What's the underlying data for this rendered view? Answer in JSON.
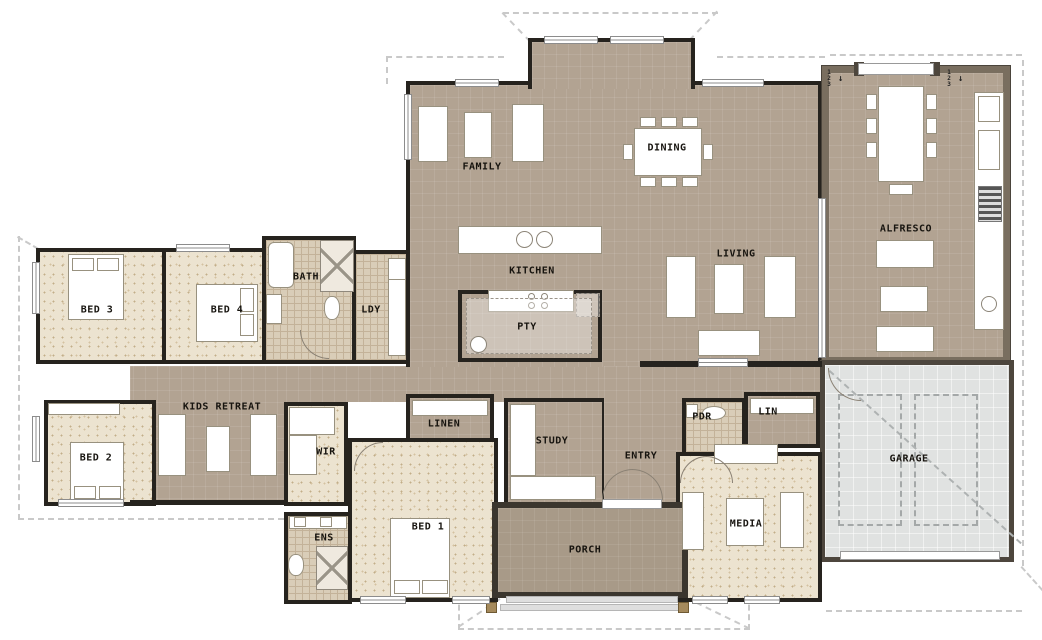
{
  "plan": {
    "rooms": {
      "family": {
        "label": "FAMILY"
      },
      "dining": {
        "label": "DINING"
      },
      "kitchen": {
        "label": "KITCHEN"
      },
      "pantry": {
        "label": "PTY"
      },
      "laundry": {
        "label": "LDY"
      },
      "bath": {
        "label": "BATH"
      },
      "bed3": {
        "label": "BED 3"
      },
      "bed4": {
        "label": "BED 4"
      },
      "bed2": {
        "label": "BED 2"
      },
      "kids_retreat": {
        "label": "KIDS RETREAT"
      },
      "wir": {
        "label": "WIR"
      },
      "ens": {
        "label": "ENS"
      },
      "bed1": {
        "label": "BED 1"
      },
      "linen": {
        "label": "LINEN"
      },
      "study": {
        "label": "STUDY"
      },
      "entry": {
        "label": "ENTRY"
      },
      "porch": {
        "label": "PORCH"
      },
      "pdr": {
        "label": "PDR"
      },
      "lin": {
        "label": "LIN"
      },
      "media": {
        "label": "MEDIA"
      },
      "garage": {
        "label": "GARAGE"
      },
      "living": {
        "label": "LIVING"
      },
      "alfresco": {
        "label": "ALFRESCO"
      }
    },
    "wall_markers": {
      "m1": "1",
      "m2": "2",
      "m3": "3",
      "arrow": "↓"
    },
    "colors": {
      "floor_tan": "#b2a392",
      "carpet": "#ece3d0",
      "tile": "#d9cdb8",
      "garage_floor": "#e0e2e1",
      "porch_floor": "#a89a88",
      "interior_wall": "#26231e",
      "exterior_wall_render": "#796e5f",
      "roof_dash": "#c9c9c9"
    }
  }
}
